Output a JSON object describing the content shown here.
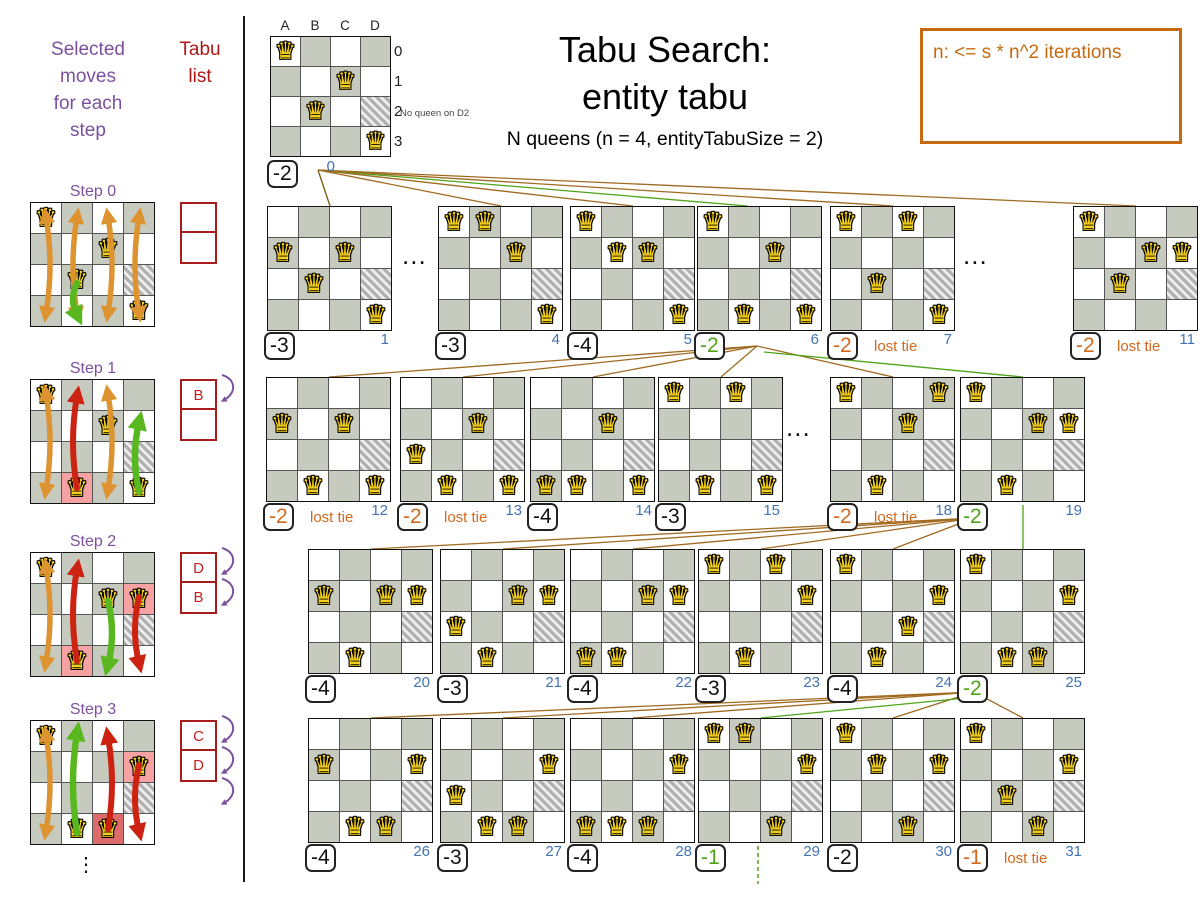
{
  "glyphs": {
    "queen": "♛",
    "ellipsis_v": "⋮",
    "ellipsis_h": "..."
  },
  "colors": {
    "purple": "#7b519d",
    "tabu_red": "#a61c1c",
    "index_blue": "#4272b2",
    "green": "#4fa318",
    "orange": "#d2691e",
    "brown": "#a06a20",
    "brown_dark": "#7a5a08",
    "legend_orange": "#c66a11",
    "board_gray": "#c7cabf",
    "pink": "#f7a2a2",
    "red_pink": "#dd6b6b",
    "queen_yellow": "#f4d01d",
    "arrow_orange": "#dd9330",
    "arrow_red": "#cc2211",
    "arrow_green": "#59b81f"
  },
  "left": {
    "title": "Selected\nmoves\nfor each\nstep",
    "tabu_title": "Tabu\nlist",
    "ellipsis": "⋮",
    "steps": [
      {
        "label": "Step 0",
        "y": 202,
        "queens": [
          "A0",
          "C1",
          "B2",
          "D3"
        ],
        "pink": [],
        "redpink": [],
        "tabu": [
          "",
          ""
        ],
        "tabu_arrows": 0,
        "arrows": [
          {
            "col": 0,
            "kind": "orange"
          },
          {
            "col": 1,
            "kind": "orange"
          },
          {
            "col": 2,
            "kind": "orange"
          },
          {
            "col": 3,
            "kind": "orange"
          },
          {
            "col": 1,
            "kind": "green",
            "y1": 80,
            "y2": 112
          }
        ]
      },
      {
        "label": "Step 1",
        "y": 379,
        "queens": [
          "A0",
          "C1",
          "B3",
          "D3"
        ],
        "pink": [
          "B3"
        ],
        "redpink": [],
        "tabu": [
          "B",
          ""
        ],
        "tabu_arrows": 1,
        "arrows": [
          {
            "col": 0,
            "kind": "orange"
          },
          {
            "col": 1,
            "kind": "red",
            "y1": 108,
            "y2": 16
          },
          {
            "col": 2,
            "kind": "orange"
          },
          {
            "col": 3,
            "kind": "green",
            "y1": 112,
            "y2": 42
          }
        ]
      },
      {
        "label": "Step 2",
        "y": 552,
        "queens": [
          "A0",
          "C1",
          "D1",
          "B3"
        ],
        "pink": [
          "D1",
          "B3"
        ],
        "redpink": [],
        "tabu": [
          "D",
          "B"
        ],
        "tabu_arrows": 2,
        "arrows": [
          {
            "col": 0,
            "kind": "orange"
          },
          {
            "col": 1,
            "kind": "red",
            "y1": 108,
            "y2": 16
          },
          {
            "col": 2,
            "kind": "green",
            "y1": 48,
            "y2": 112
          },
          {
            "col": 3,
            "kind": "red",
            "y1": 44,
            "y2": 110
          }
        ]
      },
      {
        "label": "Step 3",
        "y": 720,
        "queens": [
          "A0",
          "D1",
          "B3",
          "C3"
        ],
        "pink": [
          "D1"
        ],
        "redpink": [
          "C3"
        ],
        "tabu": [
          "C",
          "D"
        ],
        "tabu_arrows": 3,
        "arrows": [
          {
            "col": 0,
            "kind": "orange"
          },
          {
            "col": 1,
            "kind": "green",
            "y1": 112,
            "y2": 12
          },
          {
            "col": 2,
            "kind": "red",
            "y1": 108,
            "y2": 16
          },
          {
            "col": 3,
            "kind": "red",
            "y1": 44,
            "y2": 110
          }
        ]
      }
    ]
  },
  "root": {
    "x": 270,
    "y": 36,
    "cell": 29,
    "cols": [
      "A",
      "B",
      "C",
      "D"
    ],
    "rows": [
      "0",
      "1",
      "2",
      "3"
    ],
    "queens": [
      "A0",
      "C1",
      "B2",
      "D3"
    ],
    "hatched": "D2",
    "note": "No queen on D2",
    "score": "-2",
    "index": "0"
  },
  "title": {
    "line1": "Tabu Search:",
    "line2": "entity tabu",
    "subtitle": "N queens (n = 4, entityTabuSize = 2)"
  },
  "legend": {
    "text": "n: <= s * n^2 iterations"
  },
  "tree": {
    "cell": 30,
    "hatched": "D2",
    "lost_tie": "lost tie",
    "boards": [
      {
        "id": "1",
        "x": 267,
        "y": 206,
        "queens": [
          "A1",
          "C1",
          "B2",
          "D3"
        ],
        "score": "-3",
        "state": "normal"
      },
      {
        "id": "4",
        "x": 438,
        "y": 206,
        "queens": [
          "A0",
          "B0",
          "C1",
          "D3"
        ],
        "score": "-3",
        "state": "normal"
      },
      {
        "id": "5",
        "x": 570,
        "y": 206,
        "queens": [
          "A0",
          "B1",
          "C1",
          "D3"
        ],
        "score": "-4",
        "state": "normal"
      },
      {
        "id": "6",
        "x": 697,
        "y": 206,
        "queens": [
          "A0",
          "C1",
          "B3",
          "D3"
        ],
        "score": "-2",
        "state": "selected"
      },
      {
        "id": "7",
        "x": 830,
        "y": 206,
        "queens": [
          "A0",
          "C0",
          "B2",
          "D3"
        ],
        "score": "-2",
        "state": "lost"
      },
      {
        "id": "11",
        "x": 1073,
        "y": 206,
        "queens": [
          "A0",
          "C1",
          "D1",
          "B2"
        ],
        "score": "-2",
        "state": "lost"
      },
      {
        "id": "12",
        "x": 266,
        "y": 377,
        "queens": [
          "A1",
          "C1",
          "B3",
          "D3"
        ],
        "score": "-2",
        "state": "lost"
      },
      {
        "id": "13",
        "x": 400,
        "y": 377,
        "queens": [
          "C1",
          "A2",
          "B3",
          "D3"
        ],
        "score": "-2",
        "state": "lost"
      },
      {
        "id": "14",
        "x": 530,
        "y": 377,
        "queens": [
          "C1",
          "A3",
          "B3",
          "D3"
        ],
        "score": "-4",
        "state": "normal"
      },
      {
        "id": "15",
        "x": 658,
        "y": 377,
        "queens": [
          "A0",
          "C0",
          "B3",
          "D3"
        ],
        "score": "-3",
        "state": "normal"
      },
      {
        "id": "18",
        "x": 830,
        "y": 377,
        "queens": [
          "A0",
          "D0",
          "C1",
          "B3"
        ],
        "score": "-2",
        "state": "lost"
      },
      {
        "id": "19",
        "x": 960,
        "y": 377,
        "queens": [
          "A0",
          "C1",
          "D1",
          "B3"
        ],
        "score": "-2",
        "state": "selected"
      },
      {
        "id": "20",
        "x": 308,
        "y": 549,
        "queens": [
          "A1",
          "C1",
          "D1",
          "B3"
        ],
        "score": "-4",
        "state": "normal"
      },
      {
        "id": "21",
        "x": 440,
        "y": 549,
        "queens": [
          "C1",
          "D1",
          "A2",
          "B3"
        ],
        "score": "-3",
        "state": "normal"
      },
      {
        "id": "22",
        "x": 570,
        "y": 549,
        "queens": [
          "C1",
          "D1",
          "A3",
          "B3"
        ],
        "score": "-4",
        "state": "normal"
      },
      {
        "id": "23",
        "x": 698,
        "y": 549,
        "queens": [
          "A0",
          "C0",
          "D1",
          "B3"
        ],
        "score": "-3",
        "state": "normal"
      },
      {
        "id": "24",
        "x": 830,
        "y": 549,
        "queens": [
          "A0",
          "D1",
          "C2",
          "B3"
        ],
        "score": "-4",
        "state": "normal"
      },
      {
        "id": "25",
        "x": 960,
        "y": 549,
        "queens": [
          "A0",
          "D1",
          "B3",
          "C3"
        ],
        "score": "-2",
        "state": "selected"
      },
      {
        "id": "26",
        "x": 308,
        "y": 718,
        "queens": [
          "A1",
          "D1",
          "B3",
          "C3"
        ],
        "score": "-4",
        "state": "normal"
      },
      {
        "id": "27",
        "x": 440,
        "y": 718,
        "queens": [
          "D1",
          "A2",
          "B3",
          "C3"
        ],
        "score": "-3",
        "state": "normal"
      },
      {
        "id": "28",
        "x": 570,
        "y": 718,
        "queens": [
          "D1",
          "A3",
          "B3",
          "C3"
        ],
        "score": "-4",
        "state": "normal"
      },
      {
        "id": "29",
        "x": 698,
        "y": 718,
        "queens": [
          "A0",
          "B0",
          "D1",
          "C3"
        ],
        "score": "-1",
        "state": "selected"
      },
      {
        "id": "30",
        "x": 830,
        "y": 718,
        "queens": [
          "A0",
          "B1",
          "D1",
          "C3"
        ],
        "score": "-2",
        "state": "normal"
      },
      {
        "id": "31",
        "x": 960,
        "y": 718,
        "queens": [
          "A0",
          "B2",
          "D1",
          "C3"
        ],
        "score": "-1",
        "state": "lost"
      }
    ],
    "ellipses": [
      {
        "x": 402,
        "y": 240
      },
      {
        "x": 963,
        "y": 240
      },
      {
        "x": 786,
        "y": 412
      }
    ],
    "edges": [
      [
        318,
        170,
        330,
        206,
        "d"
      ],
      [
        318,
        170,
        501,
        206,
        "b"
      ],
      [
        318,
        170,
        633,
        206,
        "b"
      ],
      [
        318,
        170,
        748,
        206,
        "g"
      ],
      [
        318,
        170,
        893,
        206,
        "b"
      ],
      [
        318,
        170,
        1136,
        206,
        "b"
      ],
      [
        757,
        346,
        329,
        377,
        "b"
      ],
      [
        757,
        346,
        463,
        377,
        "b"
      ],
      [
        757,
        346,
        593,
        377,
        "b"
      ],
      [
        757,
        346,
        721,
        377,
        "b"
      ],
      [
        757,
        346,
        893,
        377,
        "b"
      ],
      [
        764,
        352,
        1023,
        377,
        "g"
      ],
      [
        974,
        518,
        371,
        549,
        "b"
      ],
      [
        974,
        518,
        503,
        549,
        "b"
      ],
      [
        974,
        518,
        633,
        549,
        "b"
      ],
      [
        974,
        518,
        761,
        549,
        "b"
      ],
      [
        974,
        518,
        893,
        549,
        "b"
      ],
      [
        1023,
        505,
        1023,
        549,
        "g"
      ],
      [
        974,
        692,
        371,
        718,
        "b"
      ],
      [
        974,
        692,
        503,
        718,
        "b"
      ],
      [
        974,
        692,
        633,
        718,
        "b"
      ],
      [
        974,
        692,
        893,
        718,
        "b"
      ],
      [
        974,
        692,
        1023,
        718,
        "b"
      ],
      [
        976,
        697,
        761,
        718,
        "g"
      ]
    ],
    "dashed": [
      758,
      846,
      758,
      884
    ]
  }
}
